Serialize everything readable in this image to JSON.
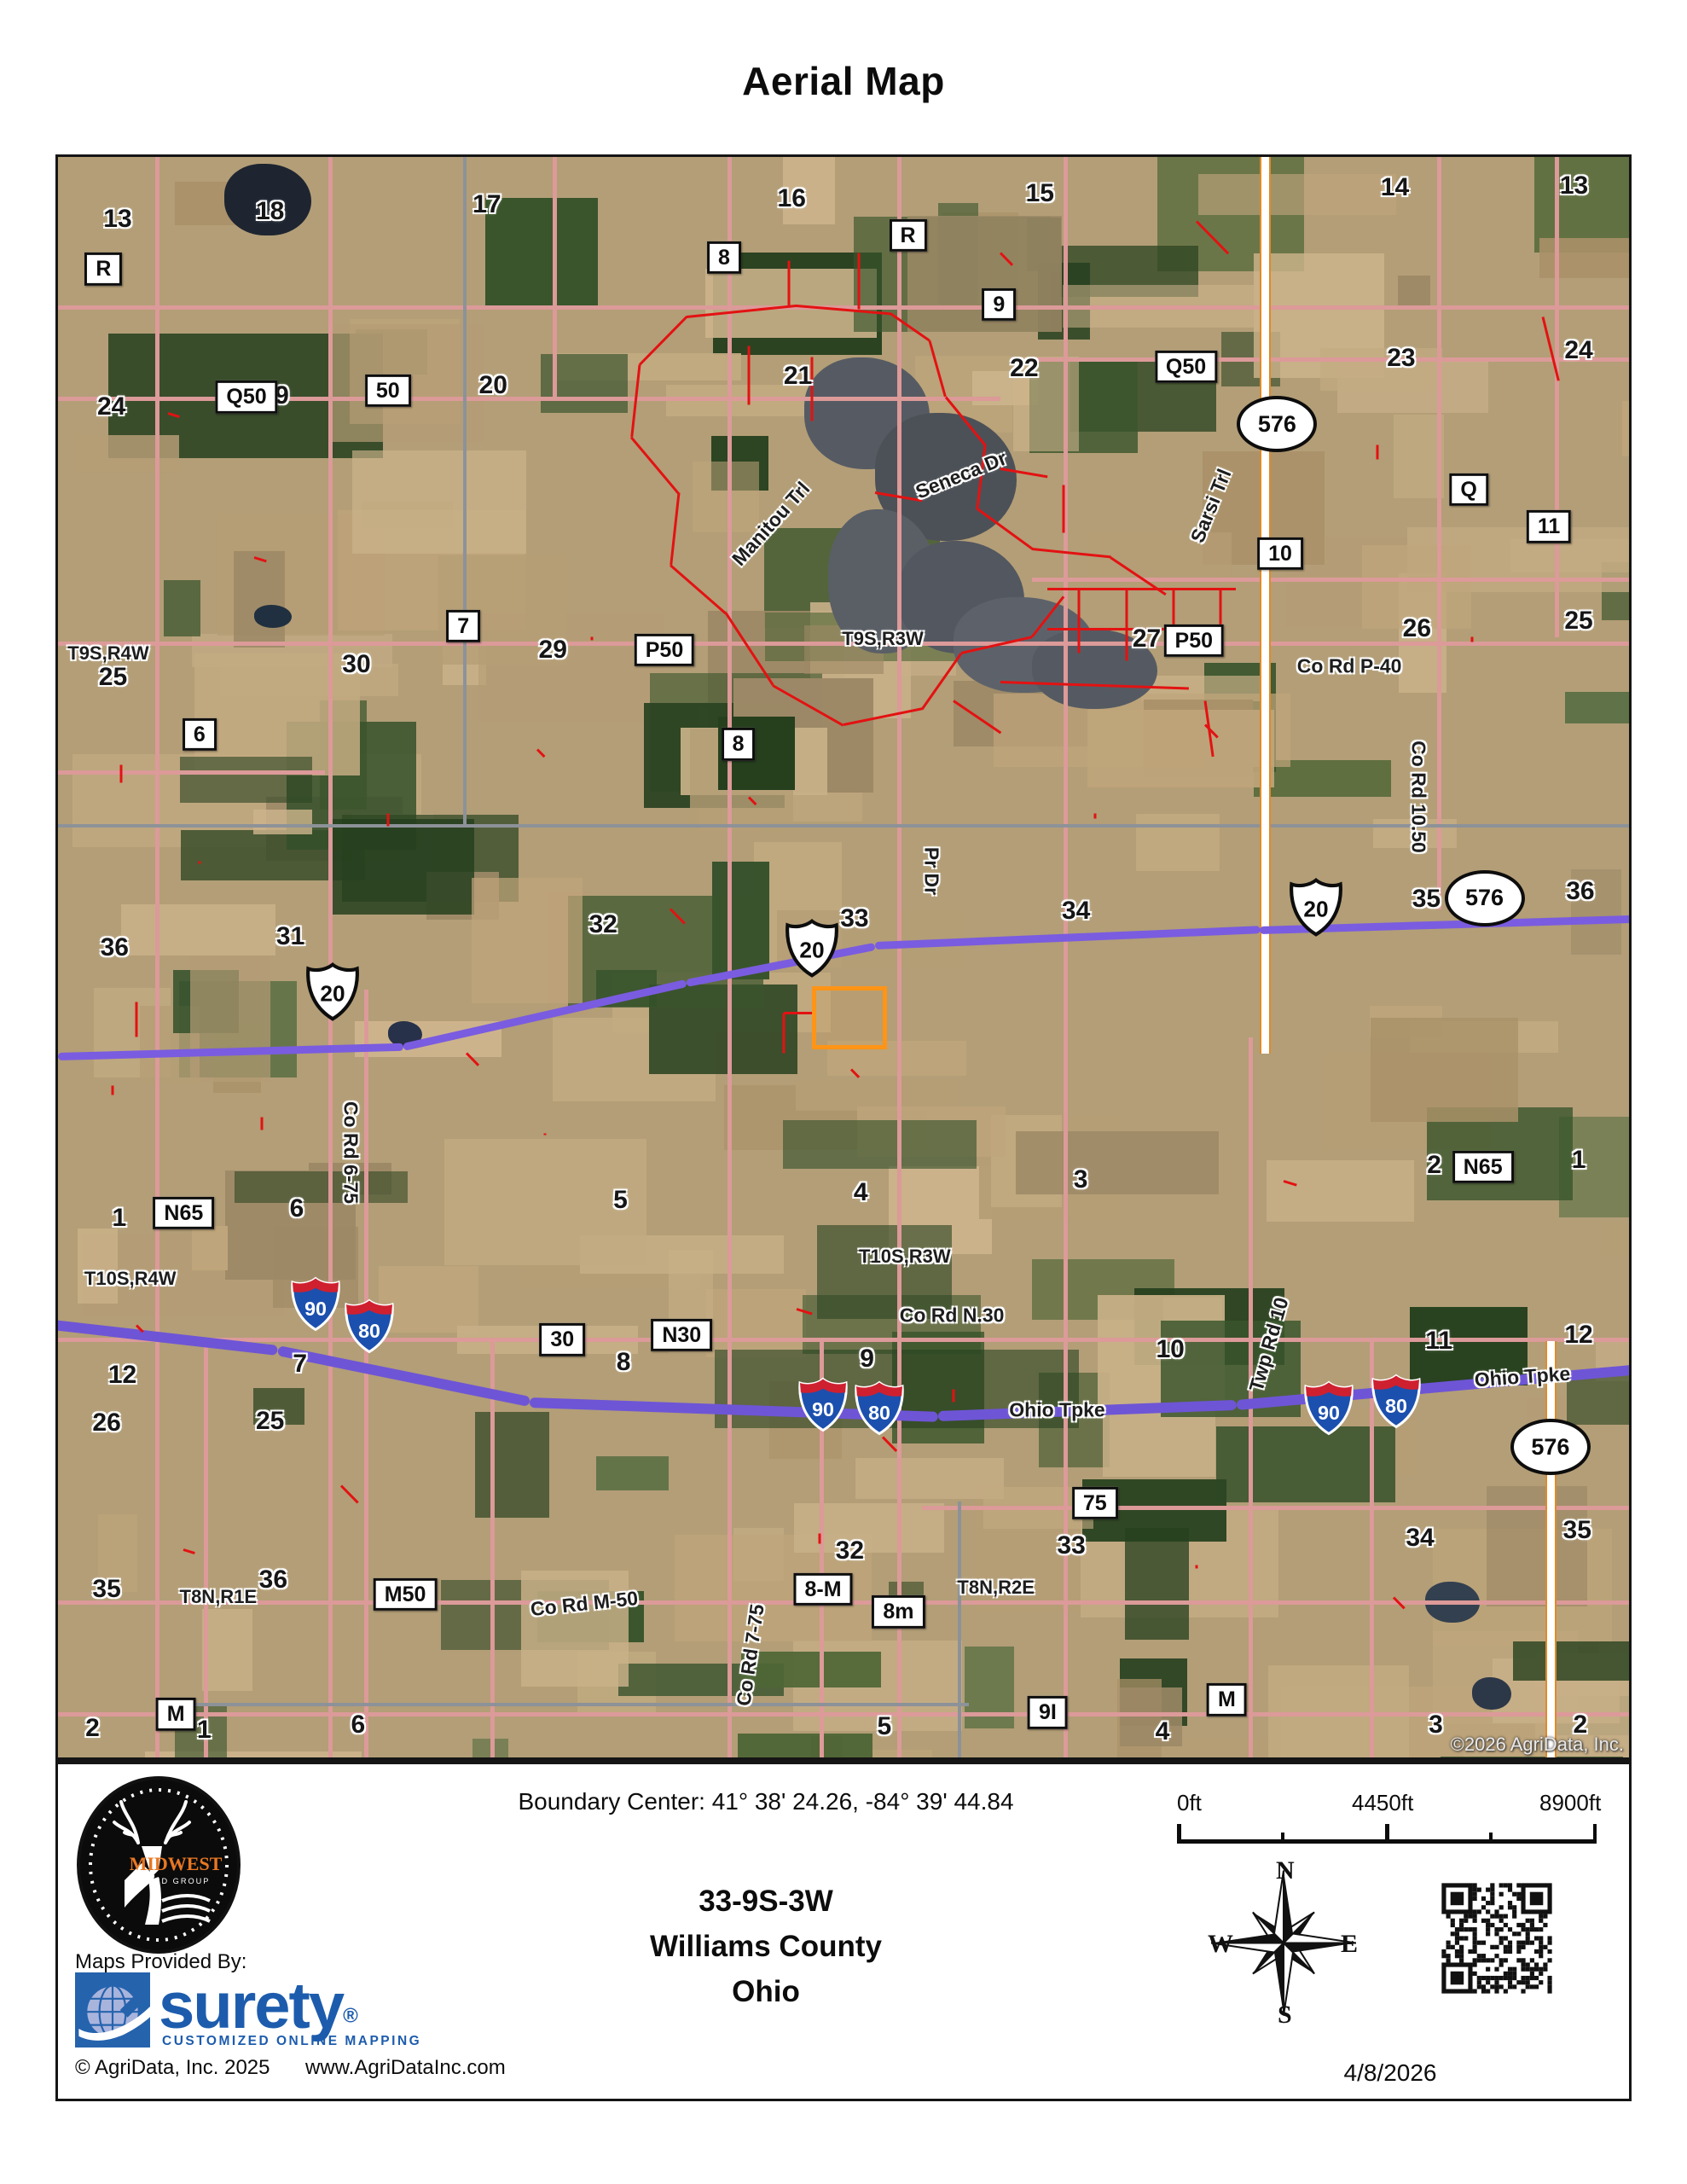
{
  "title": "Aerial Map",
  "map": {
    "copyright": "©2026 AgriData, Inc.",
    "boxed_labels": [
      {
        "t": "R",
        "x": 2.9,
        "y": 7.0
      },
      {
        "t": "Q50",
        "x": 12.0,
        "y": 15.0
      },
      {
        "t": "50",
        "x": 21.0,
        "y": 14.6
      },
      {
        "t": "8",
        "x": 42.4,
        "y": 6.3
      },
      {
        "t": "R",
        "x": 54.1,
        "y": 4.9
      },
      {
        "t": "9",
        "x": 59.9,
        "y": 9.2
      },
      {
        "t": "Q50",
        "x": 71.8,
        "y": 13.1
      },
      {
        "t": "Q",
        "x": 89.8,
        "y": 20.8
      },
      {
        "t": "11",
        "x": 94.9,
        "y": 23.1
      },
      {
        "t": "10",
        "x": 77.8,
        "y": 24.8
      },
      {
        "t": "7",
        "x": 25.8,
        "y": 29.3
      },
      {
        "t": "P50",
        "x": 38.6,
        "y": 30.8
      },
      {
        "t": "6",
        "x": 9.0,
        "y": 36.1
      },
      {
        "t": "8",
        "x": 43.3,
        "y": 36.7
      },
      {
        "t": "P50",
        "x": 72.3,
        "y": 30.2
      },
      {
        "t": "N65",
        "x": 8.0,
        "y": 66.0
      },
      {
        "t": "N65",
        "x": 90.7,
        "y": 63.1
      },
      {
        "t": "30",
        "x": 32.1,
        "y": 73.9
      },
      {
        "t": "N30",
        "x": 39.7,
        "y": 73.6
      },
      {
        "t": "75",
        "x": 66.0,
        "y": 84.1
      },
      {
        "t": "M50",
        "x": 22.1,
        "y": 89.8
      },
      {
        "t": "8-M",
        "x": 48.7,
        "y": 89.5
      },
      {
        "t": "8m",
        "x": 53.5,
        "y": 90.9
      },
      {
        "t": "M",
        "x": 7.5,
        "y": 97.3
      },
      {
        "t": "M",
        "x": 74.4,
        "y": 96.4
      },
      {
        "t": "9I",
        "x": 63.0,
        "y": 97.2
      }
    ],
    "halo_numbers": [
      {
        "t": "13",
        "x": 3.8,
        "y": 3.9
      },
      {
        "t": "18",
        "x": 13.5,
        "y": 3.4
      },
      {
        "t": "17",
        "x": 27.3,
        "y": 3.0
      },
      {
        "t": "16",
        "x": 46.7,
        "y": 2.6
      },
      {
        "t": "15",
        "x": 62.5,
        "y": 2.3
      },
      {
        "t": "14",
        "x": 85.1,
        "y": 1.9
      },
      {
        "t": "13",
        "x": 96.5,
        "y": 1.8
      },
      {
        "t": "24",
        "x": 3.4,
        "y": 15.6
      },
      {
        "t": "19",
        "x": 13.8,
        "y": 14.9
      },
      {
        "t": "20",
        "x": 27.7,
        "y": 14.3
      },
      {
        "t": "21",
        "x": 47.1,
        "y": 13.7
      },
      {
        "t": "22",
        "x": 61.5,
        "y": 13.2
      },
      {
        "t": "23",
        "x": 85.5,
        "y": 12.6
      },
      {
        "t": "24",
        "x": 96.8,
        "y": 12.1
      },
      {
        "t": "25",
        "x": 3.5,
        "y": 32.5
      },
      {
        "t": "30",
        "x": 19.0,
        "y": 31.7
      },
      {
        "t": "29",
        "x": 31.5,
        "y": 30.8
      },
      {
        "t": "27",
        "x": 69.3,
        "y": 30.1
      },
      {
        "t": "26",
        "x": 86.5,
        "y": 29.5
      },
      {
        "t": "25",
        "x": 96.8,
        "y": 29.0
      },
      {
        "t": "36",
        "x": 3.6,
        "y": 49.4
      },
      {
        "t": "31",
        "x": 14.8,
        "y": 48.7
      },
      {
        "t": "32",
        "x": 34.7,
        "y": 48.0
      },
      {
        "t": "33",
        "x": 50.7,
        "y": 47.6
      },
      {
        "t": "34",
        "x": 64.8,
        "y": 47.1
      },
      {
        "t": "35",
        "x": 87.1,
        "y": 46.4
      },
      {
        "t": "36",
        "x": 96.9,
        "y": 45.9
      },
      {
        "t": "1",
        "x": 3.9,
        "y": 66.3
      },
      {
        "t": "6",
        "x": 15.2,
        "y": 65.7
      },
      {
        "t": "5",
        "x": 35.8,
        "y": 65.2
      },
      {
        "t": "4",
        "x": 51.1,
        "y": 64.7
      },
      {
        "t": "3",
        "x": 65.1,
        "y": 63.9
      },
      {
        "t": "2",
        "x": 87.6,
        "y": 63.0
      },
      {
        "t": "1",
        "x": 96.8,
        "y": 62.7
      },
      {
        "t": "12",
        "x": 4.1,
        "y": 76.1
      },
      {
        "t": "7",
        "x": 15.4,
        "y": 75.4
      },
      {
        "t": "8",
        "x": 36.0,
        "y": 75.3
      },
      {
        "t": "9",
        "x": 51.5,
        "y": 75.1
      },
      {
        "t": "10",
        "x": 70.8,
        "y": 74.5
      },
      {
        "t": "11",
        "x": 87.9,
        "y": 74.0
      },
      {
        "t": "12",
        "x": 96.8,
        "y": 73.6
      },
      {
        "t": "26",
        "x": 3.1,
        "y": 79.1
      },
      {
        "t": "25",
        "x": 13.5,
        "y": 79.0
      },
      {
        "t": "32",
        "x": 50.4,
        "y": 87.1
      },
      {
        "t": "33",
        "x": 64.5,
        "y": 86.8
      },
      {
        "t": "34",
        "x": 86.7,
        "y": 86.3
      },
      {
        "t": "35",
        "x": 96.7,
        "y": 85.8
      },
      {
        "t": "35",
        "x": 3.1,
        "y": 89.5
      },
      {
        "t": "36",
        "x": 13.7,
        "y": 88.9
      },
      {
        "t": "2",
        "x": 2.2,
        "y": 98.2
      },
      {
        "t": "1",
        "x": 9.3,
        "y": 98.3
      },
      {
        "t": "6",
        "x": 19.1,
        "y": 98.0
      },
      {
        "t": "5",
        "x": 52.6,
        "y": 98.1
      },
      {
        "t": "4",
        "x": 70.3,
        "y": 98.4
      },
      {
        "t": "3",
        "x": 87.7,
        "y": 98.0
      },
      {
        "t": "2",
        "x": 96.9,
        "y": 98.0
      }
    ],
    "road_names": [
      {
        "t": "T9S,R4W",
        "x": 3.2,
        "y": 31.0,
        "r": 0,
        "cls": "trslab"
      },
      {
        "t": "T9S,R3W",
        "x": 52.5,
        "y": 30.1,
        "r": 0,
        "cls": "trslab"
      },
      {
        "t": "T10S,R4W",
        "x": 4.6,
        "y": 70.1,
        "r": 0,
        "cls": "trslab"
      },
      {
        "t": "T10S,R3W",
        "x": 53.9,
        "y": 68.7,
        "r": 0,
        "cls": "trslab"
      },
      {
        "t": "T8N,R1E",
        "x": 10.2,
        "y": 90.0,
        "r": 0,
        "cls": "trslab"
      },
      {
        "t": "T8N,R2E",
        "x": 59.7,
        "y": 89.4,
        "r": 0,
        "cls": "trslab"
      },
      {
        "t": "Seneca Dr",
        "x": 57.5,
        "y": 19.9,
        "r": -22
      },
      {
        "t": "Manitou Trl",
        "x": 45.4,
        "y": 22.9,
        "r": -48
      },
      {
        "t": "Sarsi Trl",
        "x": 73.4,
        "y": 21.8,
        "r": -68
      },
      {
        "t": "Co Rd P-40",
        "x": 82.2,
        "y": 31.8,
        "r": 0
      },
      {
        "t": "Co Rd 10.50",
        "x": 86.6,
        "y": 40.0,
        "r": 90
      },
      {
        "t": "Pr Dr",
        "x": 55.6,
        "y": 44.6,
        "r": 90
      },
      {
        "t": "Co Rd 6-75",
        "x": 18.6,
        "y": 62.2,
        "r": 90
      },
      {
        "t": "Co Rd N.30",
        "x": 56.9,
        "y": 72.4,
        "r": 0
      },
      {
        "t": "Twp Rd 10",
        "x": 77.1,
        "y": 74.2,
        "r": -74
      },
      {
        "t": "Ohio Tpke",
        "x": 63.6,
        "y": 78.3,
        "r": 0
      },
      {
        "t": "Ohio Tpke",
        "x": 93.2,
        "y": 76.2,
        "r": -4
      },
      {
        "t": "Co Rd M-50",
        "x": 33.5,
        "y": 90.4,
        "r": -6
      },
      {
        "t": "Co Rd 7-75",
        "x": 44.1,
        "y": 93.6,
        "r": -82
      }
    ],
    "us_shields": [
      {
        "n": "20",
        "x": 17.5,
        "y": 52.3
      },
      {
        "n": "20",
        "x": 48.0,
        "y": 49.6
      },
      {
        "n": "20",
        "x": 80.1,
        "y": 47.0
      }
    ],
    "interstate_shields": [
      {
        "n": "90",
        "x": 16.4,
        "y": 71.8
      },
      {
        "n": "80",
        "x": 19.8,
        "y": 73.2
      },
      {
        "n": "90",
        "x": 48.7,
        "y": 78.1
      },
      {
        "n": "80",
        "x": 52.3,
        "y": 78.3
      },
      {
        "n": "90",
        "x": 80.9,
        "y": 78.3
      },
      {
        "n": "80",
        "x": 85.2,
        "y": 77.9
      }
    ],
    "oval_shields": [
      {
        "n": "576",
        "x": 77.6,
        "y": 16.7
      },
      {
        "n": "576",
        "x": 90.8,
        "y": 46.3
      },
      {
        "n": "576",
        "x": 95.0,
        "y": 80.6
      }
    ]
  },
  "footer": {
    "boundary_center": "Boundary Center: 41° 38' 24.26,  -84° 39' 44.84",
    "trs": "33-9S-3W",
    "county": "Williams County",
    "state": "Ohio",
    "scale": {
      "start": "0ft",
      "mid": "4450ft",
      "end": "8900ft"
    },
    "compass": {
      "n": "N",
      "e": "E",
      "s": "S",
      "w": "W"
    },
    "date": "4/8/2026",
    "logo_brand": "MIDWEST",
    "logo_sub": "LAND GROUP",
    "provided_by": "Maps Provided By:",
    "surety_name": "surety",
    "surety_reg": "®",
    "surety_tagline": "CUSTOMIZED ONLINE MAPPING",
    "agridata_copyright": "© AgriData, Inc. 2025",
    "agridata_url": "www.AgriDataInc.com"
  },
  "colors": {
    "road_pink": "#dc9a99",
    "road_gray": "#8d9298",
    "highway_purple": "#7a5ce0",
    "turnpike_purple": "#6e55d6",
    "route576_orange": "#e08a28",
    "boundary_red": "#e31212",
    "parcel_orange": "#ff9416",
    "surety_blue": "#1d5cad",
    "logo_orange": "#e87722"
  }
}
